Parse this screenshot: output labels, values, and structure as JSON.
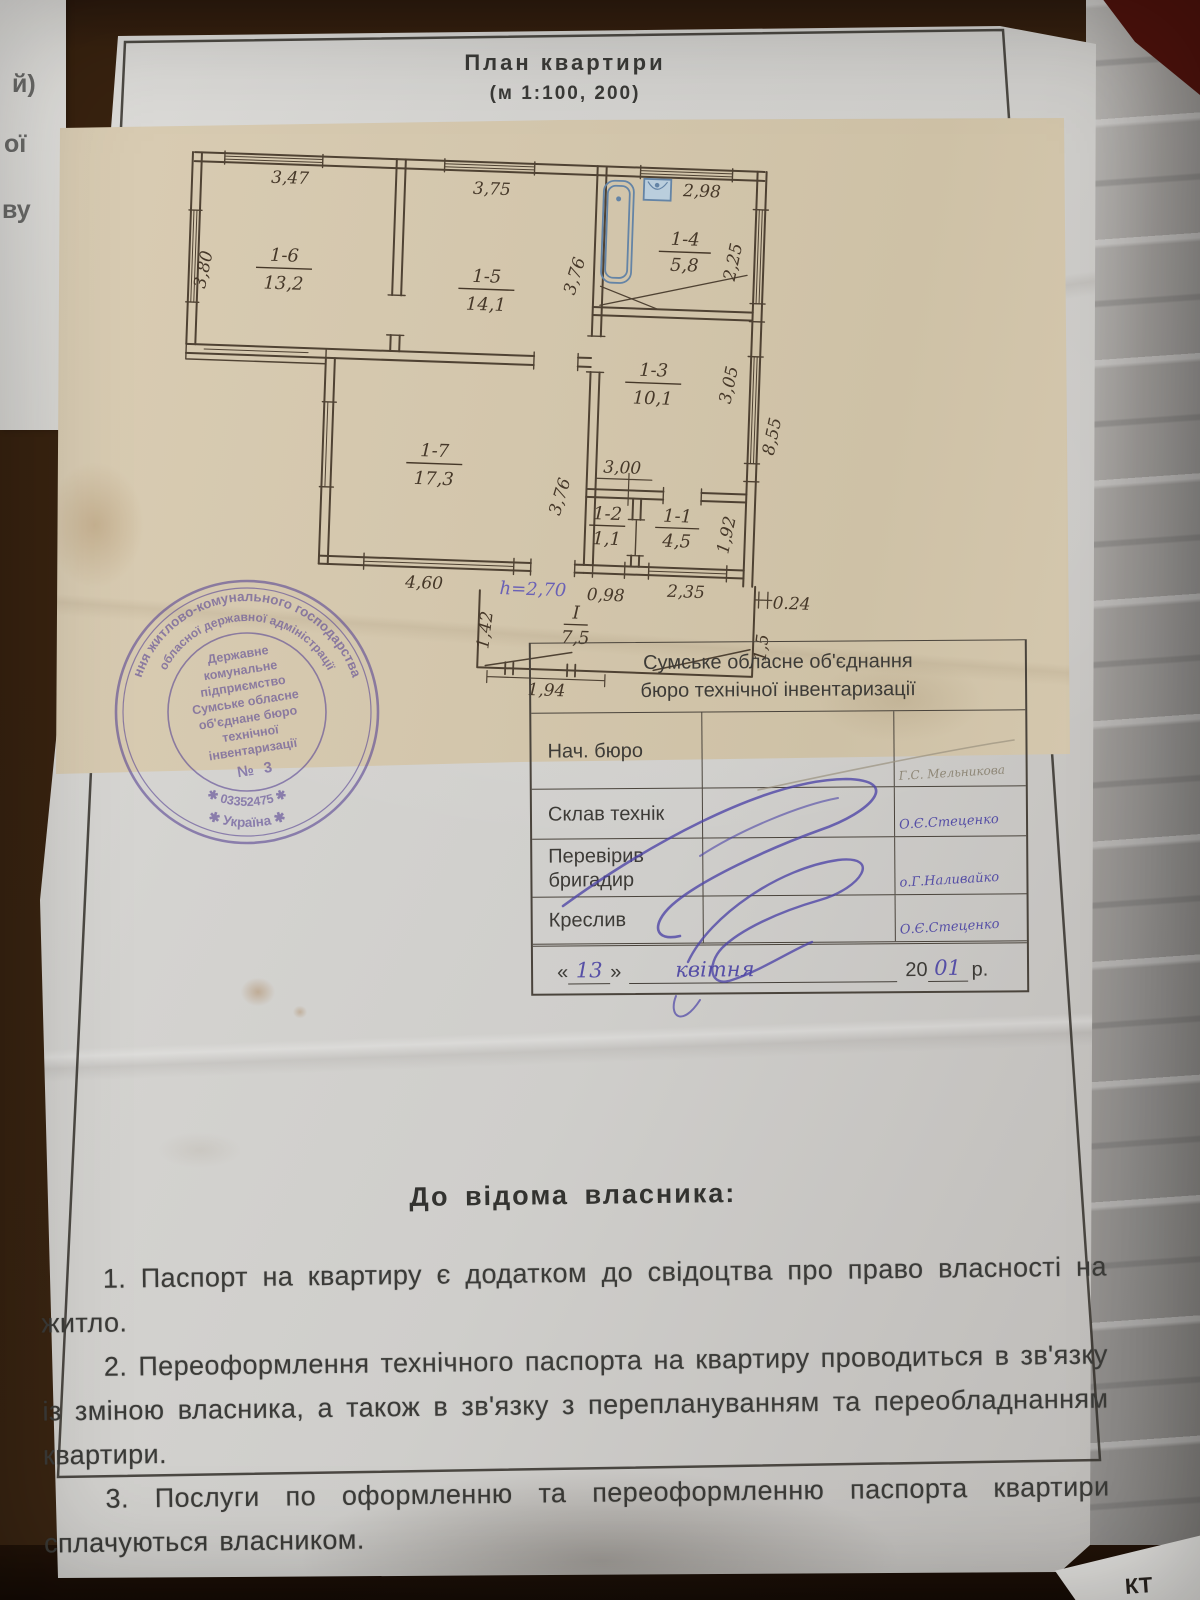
{
  "photo": {
    "left_edge_lines": [
      "й)",
      "ої",
      "ву"
    ],
    "scrap_text": "КТ"
  },
  "title": {
    "line1": "План квартири",
    "line2": "(м 1:100,  200)"
  },
  "plan": {
    "rooms": [
      {
        "id": "1-6",
        "area": "13,2"
      },
      {
        "id": "1-5",
        "area": "14,1"
      },
      {
        "id": "1-4",
        "area": "5,8"
      },
      {
        "id": "1-3",
        "area": "10,1"
      },
      {
        "id": "1-7",
        "area": "17,3"
      },
      {
        "id": "1-2",
        "area": "1,1"
      },
      {
        "id": "1-1",
        "area": "4,5"
      },
      {
        "id": "І",
        "area": "7,5"
      }
    ],
    "dims": {
      "top_16": "3,47",
      "top_15": "3,75",
      "top_14": "2,98",
      "left_16": "3,80",
      "right_15": "3,76",
      "right_14": "2,25",
      "right_13_in": "3,05",
      "right_13_out": "8,55",
      "mid_300": "3,00",
      "right_17": "3,76",
      "right_11": "1,92",
      "bot_17": "4,60",
      "height_note": "h=2,70",
      "bot_12": "0,98",
      "bot_11": "2,35",
      "porch_024": "0.24",
      "porch_left": "1,42",
      "porch_right": "1,5",
      "porch_bot": "1,94"
    }
  },
  "stamp": {
    "ring_outer": "ння житлово-комунального господарства",
    "ring_inner": "обласної державної адміністрації",
    "code": "✱ 03352475 ✱",
    "country": "✱  Україна  ✱",
    "center_lines": [
      "Державне",
      "комунальне",
      "підприємство",
      "Сумське обласне",
      "об'єднане бюро",
      "технічної",
      "інвентаризації"
    ],
    "number": "№ 3"
  },
  "table": {
    "org_line1": "Сумське обласне об'єднання",
    "org_line2": "бюро технічної інвентаризації",
    "rows": [
      {
        "label": "Нач. бюро",
        "name": "Г.С. Мельникова"
      },
      {
        "label": "Склав технік",
        "name": "О.Є.Стеценко"
      },
      {
        "label": "Перевірив бригадир",
        "name": "о.Г.Наливайко"
      },
      {
        "label": "Креслив",
        "name": "О.Є.Стеценко"
      }
    ],
    "date": {
      "open_quote": "«",
      "day": "13",
      "close_quote": "»",
      "month": "квітня",
      "year_prefix": "20",
      "year": "01",
      "suffix": "р."
    }
  },
  "notice": {
    "heading": "До відома власника:",
    "items": [
      "1. Паспорт на квартиру є додатком до свідоцтва про право власності на житло.",
      "2. Переоформлення технічного паспорта на квартиру проводиться в зв'язку із зміною власника, а також в зв'язку з переплануванням та переобладнанням квартири.",
      "3. Послуги по оформленню та переоформленню паспорта квартири сплачуються власником."
    ]
  }
}
